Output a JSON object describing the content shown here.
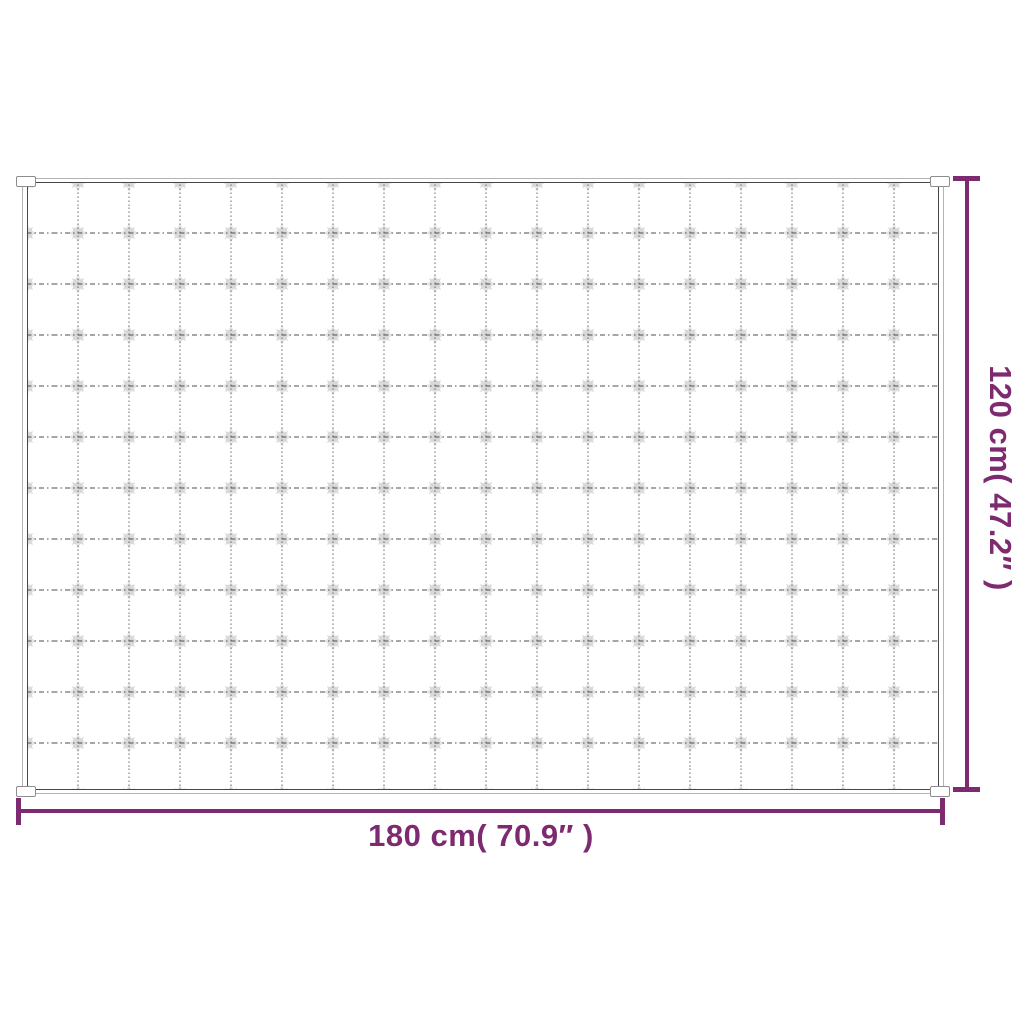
{
  "page": {
    "background_color": "#ffffff"
  },
  "diagram": {
    "type": "product-dimension-diagram",
    "subject": "quilted weighted blanket, top view",
    "accent_color": "#7d2a70",
    "width_label": "180 cm( 70.9″ )",
    "height_label": "120 cm( 47.2″ )",
    "blanket": {
      "outer_outline_color": "#b3b3b3",
      "inner_stitch_color": "#474747",
      "grid_line_color": "#565656",
      "tuft_color": "#dcdcdc",
      "grid_columns": 18,
      "grid_rows": 12,
      "corner_tab_count": 4
    }
  }
}
